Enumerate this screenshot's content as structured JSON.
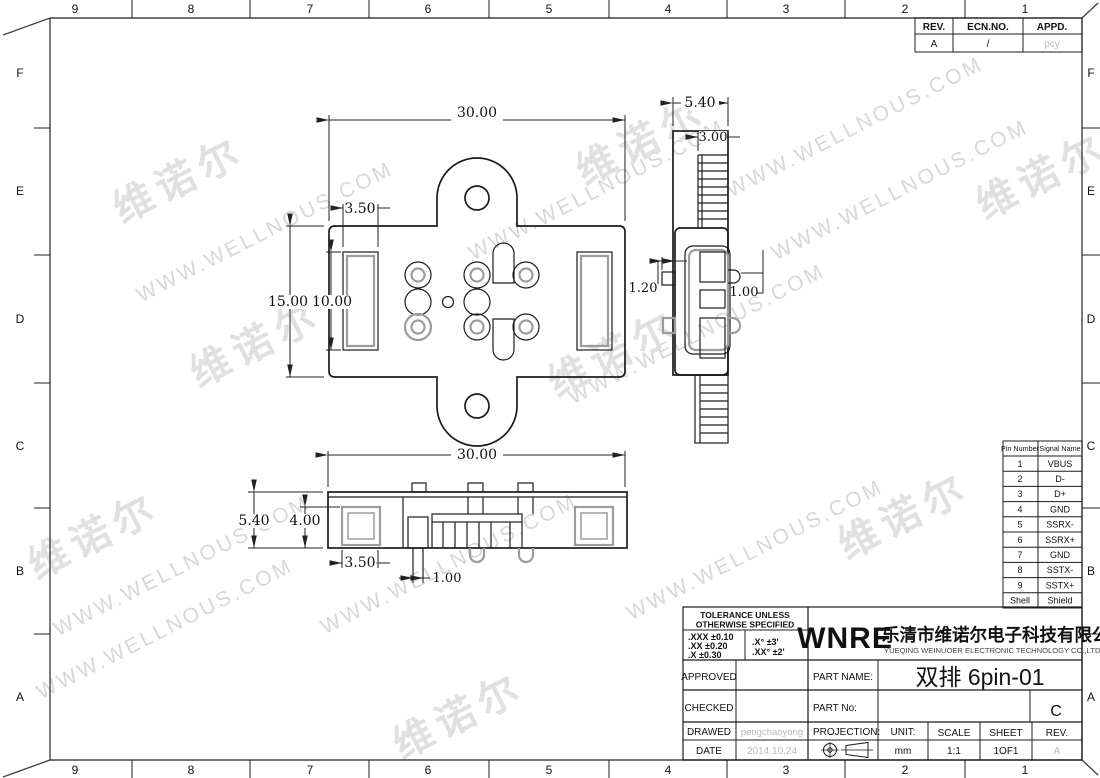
{
  "colors": {
    "line": "#1c1c1c",
    "gray_detail": "#9c9c9c",
    "ghost_text": "#b9b9b9",
    "watermark": "#d7d7d7"
  },
  "frame": {
    "cols": [
      "9",
      "8",
      "7",
      "6",
      "5",
      "4",
      "3",
      "2",
      "1"
    ],
    "rows": [
      "F",
      "E",
      "D",
      "C",
      "B",
      "A"
    ]
  },
  "watermark": {
    "url": "WWW.WELLNOUS.COM",
    "brand": "维诺尔"
  },
  "rev_table": {
    "headers": [
      "REV.",
      "ECN.NO.",
      "APPD."
    ],
    "values": [
      "A",
      "/",
      "pcy"
    ]
  },
  "pin_table": {
    "headers": [
      "Pin Number",
      "Signal Name"
    ],
    "rows": [
      [
        "1",
        "VBUS"
      ],
      [
        "2",
        "D-"
      ],
      [
        "3",
        "D+"
      ],
      [
        "4",
        "GND"
      ],
      [
        "5",
        "SSRX-"
      ],
      [
        "6",
        "SSRX+"
      ],
      [
        "7",
        "GND"
      ],
      [
        "8",
        "SSTX-"
      ],
      [
        "9",
        "SSTX+"
      ],
      [
        "Shell",
        "Shield"
      ]
    ]
  },
  "dims": {
    "front_width": "30.00",
    "front_slot_w": "3.50",
    "front_height": "15.00",
    "front_slot_h": "10.00",
    "side_width": "5.40",
    "side_rib": "3.00",
    "side_tab_left": "1.20",
    "side_tab_right": "1.00",
    "bottom_width": "30.00",
    "bottom_height": "5.40",
    "bottom_inner": "4.00",
    "bottom_slot": "3.50",
    "bottom_pin": "1.00"
  },
  "title_block": {
    "tolerance": {
      "title_line1": "TOLERANCE UNLESS",
      "title_line2": "OTHERWISE SPECIFIED",
      "rows_left": [
        ".XXX  ±0.10",
        ".XX    ±0.20",
        ".X      ±0.30"
      ],
      "rows_right": [
        ".X°    ±3'",
        ".XX°  ±2'"
      ]
    },
    "company": {
      "logo": "WNRE",
      "name_cn": "乐清市维诺尔电子科技有限公司",
      "name_en": "YUEQING WEINUOER ELECTRONIC TECHNOLOGY CO.,LTD."
    },
    "fields": {
      "approved": "APPROVED",
      "checked": "CHECKED",
      "drawed": "DRAWED",
      "date": "DATE",
      "drawed_by": "pengchaoyong",
      "date_value": "2014.10.24",
      "part_name_label": "PART NAME:",
      "part_name": "双排 6pin-01",
      "part_no_label": "PART No:",
      "projection_label": "PROJECTION:",
      "unit_label": "UNIT:",
      "unit": "mm",
      "scale_label": "SCALE",
      "scale": "1:1",
      "sheet_label": "SHEET",
      "sheet": "1OF1",
      "rev_label": "REV.",
      "rev": "A",
      "size": "C"
    }
  }
}
